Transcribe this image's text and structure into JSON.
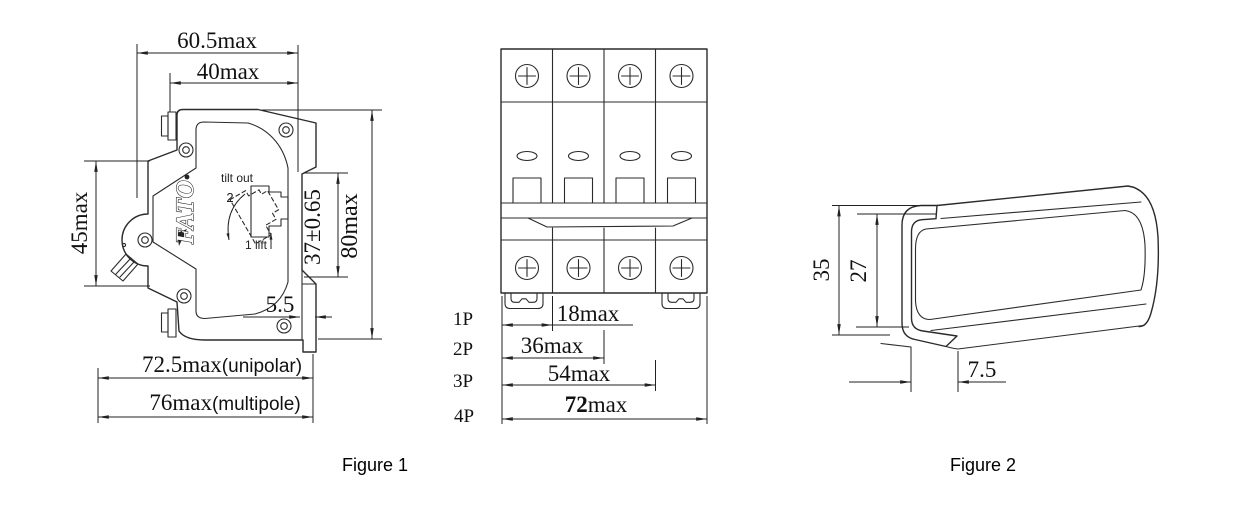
{
  "figure1": {
    "caption": "Figure 1",
    "brand_logo": "FATO",
    "tilt_note": {
      "title": "tilt out",
      "step_tilt": "2",
      "step_lift": "1 lift"
    },
    "dims": {
      "width_total": "60.5max",
      "width_body": "40max",
      "height_left": "45max",
      "height_total": "80max",
      "rail_slot": "37±0.65",
      "latch_depth": "5.5",
      "depth_unipolar": "72.5max",
      "depth_unipolar_note": "(unipolar)",
      "depth_multipole": "76max",
      "depth_multipole_note": "(multipole)"
    }
  },
  "front_view": {
    "pole_labels": [
      "1P",
      "2P",
      "3P",
      "4P"
    ],
    "width_dims": [
      "18max",
      "36max",
      "54max"
    ],
    "width_dim_4p": {
      "bold": "72",
      "suffix": "max"
    }
  },
  "figure2": {
    "caption": "Figure 2",
    "dims": {
      "height_outer": "35",
      "height_inner": "27",
      "depth": "7.5"
    }
  }
}
